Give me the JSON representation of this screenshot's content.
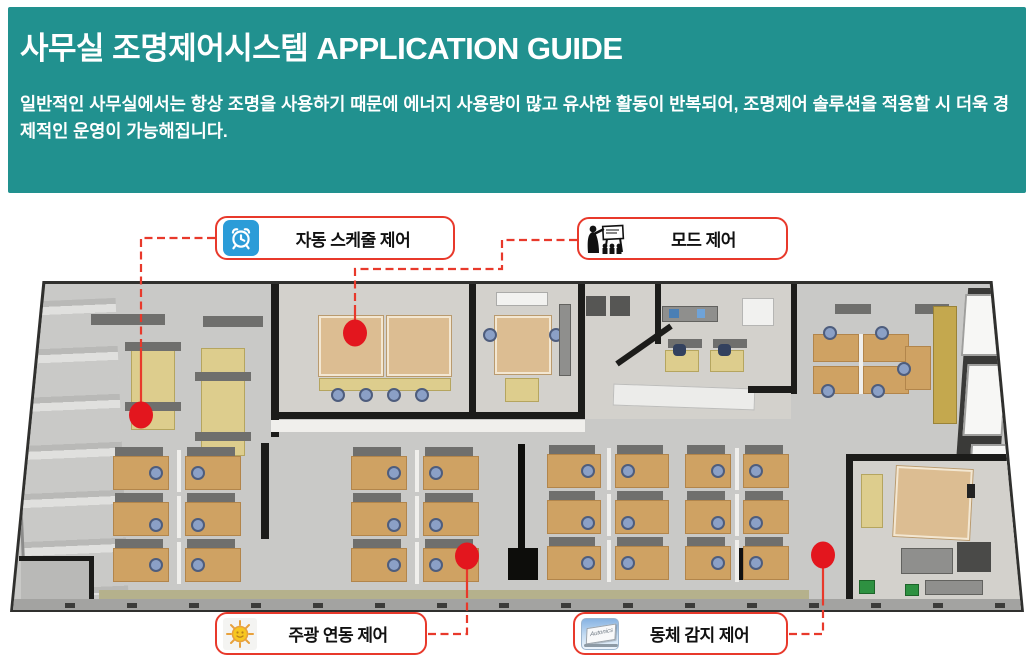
{
  "header": {
    "title": "사무실 조명제어시스템 APPLICATION GUIDE",
    "description": "일반적인 사무실에서는 항상 조명을 사용하기 때문에 에너지 사용량이 많고 유사한 활동이 반복되어, 조명제어 솔루션을 적용할 시 더욱 경제적인 운영이 가능해집니다."
  },
  "callouts": {
    "schedule": {
      "label": "자동 스케줄 제어",
      "icon": "alarm-clock-icon"
    },
    "mode": {
      "label": "모드 제어",
      "icon": "presentation-icon"
    },
    "daylight": {
      "label": "주광 연동 제어",
      "icon": "sun-icon"
    },
    "motion": {
      "label": "동체 감지 제어",
      "icon": "motion-sensor-icon",
      "icon_text": "Autonics"
    }
  },
  "floorplan": {
    "alt": "3D top view render of an office: meeting rooms, open-plan desk clusters with blue chairs, kitchenette, private office, window wall"
  },
  "colors": {
    "header_bg": "#21918f",
    "callout_border": "#e8392b",
    "connector": "#e8392b",
    "marker": "#e3161e",
    "clock_icon_bg": "#2b9cd8"
  }
}
